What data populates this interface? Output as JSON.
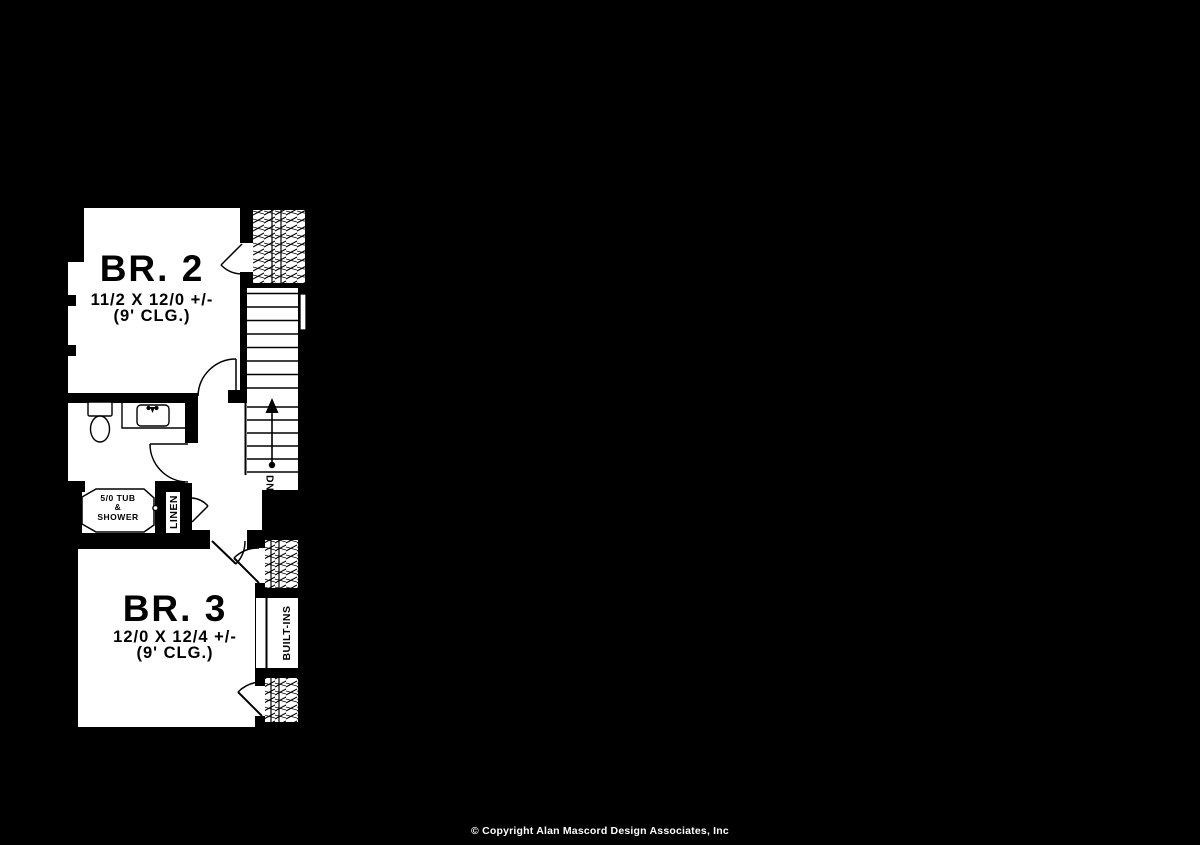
{
  "canvas": {
    "background": "#000000",
    "plan_fill": "#ffffff",
    "line_color": "#000000",
    "copyright_color": "#ffffff"
  },
  "rooms": {
    "br2": {
      "name": "BR. 2",
      "dimensions": "11/2 X 12/0 +/-",
      "ceiling": "(9' CLG.)"
    },
    "br3": {
      "name": "BR. 3",
      "dimensions": "12/0 X 12/4 +/-",
      "ceiling": "(9' CLG.)"
    }
  },
  "labels": {
    "tub_line1": "5/0 TUB",
    "tub_line2": "&",
    "tub_line3": "SHOWER",
    "linen": "LINEN",
    "builtins": "BUILT-INS",
    "stair_direction": "DN"
  },
  "footer": {
    "copyright": "© Copyright Alan Mascord Design Associates, Inc"
  }
}
